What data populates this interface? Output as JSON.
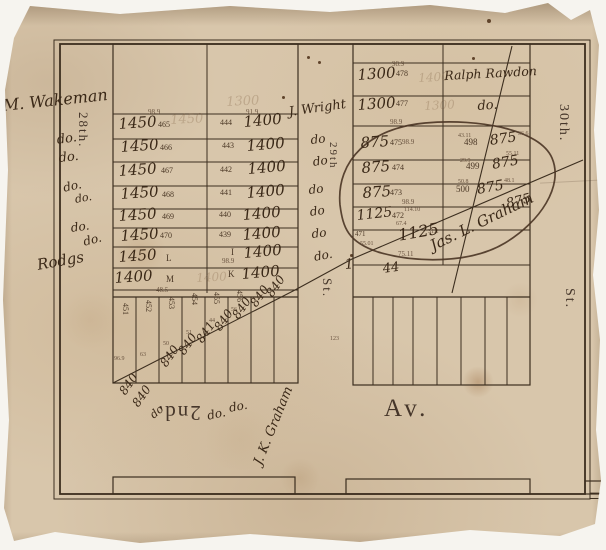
{
  "title": "Antique plat map fragment",
  "streets": {
    "left": "28th.",
    "middle": "29th",
    "middle_st": "St.",
    "right": "30th.",
    "right_st": "St.",
    "avenue_prefix": "2nd.",
    "avenue": "Av."
  },
  "colors": {
    "paper": "#d8c6ab",
    "ink_hand": "#3a2817",
    "ink_print": "#4b3826",
    "line": "#3c2e1f",
    "backdrop": "#f6f4ef"
  },
  "label_groups": {
    "margin_left": [
      {
        "t": "M. Wakeman",
        "x": 2,
        "y": 98,
        "s": 16,
        "r": -6,
        "c": "hand",
        "n": "owner-wakeman"
      },
      {
        "t": "do.",
        "x": 56,
        "y": 134,
        "s": 13,
        "r": -8,
        "c": "hand",
        "n": "ditto-mark"
      },
      {
        "t": "do.",
        "x": 58,
        "y": 152,
        "s": 13,
        "r": -6,
        "c": "hand",
        "n": "ditto-mark"
      },
      {
        "t": "do.",
        "x": 62,
        "y": 182,
        "s": 12,
        "r": -12,
        "c": "hand",
        "n": "ditto-mark"
      },
      {
        "t": "do.",
        "x": 74,
        "y": 194,
        "s": 11,
        "r": -10,
        "c": "hand",
        "n": "ditto-mark"
      },
      {
        "t": "do.",
        "x": 70,
        "y": 222,
        "s": 12,
        "r": -8,
        "c": "hand",
        "n": "ditto-mark"
      },
      {
        "t": "do.",
        "x": 82,
        "y": 236,
        "s": 12,
        "r": -14,
        "c": "hand",
        "n": "ditto-mark"
      },
      {
        "t": "Rodgs",
        "x": 36,
        "y": 258,
        "s": 15,
        "r": -10,
        "c": "hand",
        "n": "owner-rodgers"
      }
    ],
    "block_left": [
      {
        "t": "98.9",
        "x": 148,
        "y": 109,
        "s": 7,
        "c": "tiny",
        "n": "dimension"
      },
      {
        "t": "91.9",
        "x": 246,
        "y": 109,
        "s": 7,
        "c": "tiny",
        "n": "dimension"
      },
      {
        "t": "1450",
        "x": 170,
        "y": 114,
        "s": 13,
        "r": -3,
        "c": "ghost",
        "n": "erased-price"
      },
      {
        "t": "1300",
        "x": 226,
        "y": 96,
        "s": 13,
        "r": -3,
        "c": "ghost",
        "n": "erased-price"
      },
      {
        "t": "1450",
        "x": 118,
        "y": 117,
        "s": 15,
        "r": -4,
        "c": "hand",
        "n": "lot-price"
      },
      {
        "t": "465",
        "x": 158,
        "y": 121,
        "s": 8,
        "c": "print",
        "n": "lot-number"
      },
      {
        "t": "1450",
        "x": 120,
        "y": 140,
        "s": 15,
        "r": -4,
        "c": "hand",
        "n": "lot-price"
      },
      {
        "t": "466",
        "x": 160,
        "y": 144,
        "s": 8,
        "c": "print",
        "n": "lot-number"
      },
      {
        "t": "1450",
        "x": 118,
        "y": 164,
        "s": 15,
        "r": -4,
        "c": "hand",
        "n": "lot-price"
      },
      {
        "t": "467",
        "x": 161,
        "y": 167,
        "s": 8,
        "c": "print",
        "n": "lot-number"
      },
      {
        "t": "1450",
        "x": 120,
        "y": 187,
        "s": 15,
        "r": -4,
        "c": "hand",
        "n": "lot-price"
      },
      {
        "t": "468",
        "x": 162,
        "y": 191,
        "s": 8,
        "c": "print",
        "n": "lot-number"
      },
      {
        "t": "1450",
        "x": 118,
        "y": 209,
        "s": 15,
        "r": -4,
        "c": "hand",
        "n": "lot-price"
      },
      {
        "t": "469",
        "x": 162,
        "y": 213,
        "s": 8,
        "c": "print",
        "n": "lot-number"
      },
      {
        "t": "1450",
        "x": 120,
        "y": 229,
        "s": 15,
        "r": -4,
        "c": "hand",
        "n": "lot-price"
      },
      {
        "t": "470",
        "x": 160,
        "y": 232,
        "s": 8,
        "c": "print",
        "n": "lot-number"
      },
      {
        "t": "1450",
        "x": 118,
        "y": 250,
        "s": 15,
        "r": -4,
        "c": "hand",
        "n": "lot-price"
      },
      {
        "t": "L",
        "x": 166,
        "y": 254,
        "s": 9,
        "c": "print",
        "n": "lot-letter"
      },
      {
        "t": "1400",
        "x": 114,
        "y": 271,
        "s": 15,
        "r": -4,
        "c": "hand",
        "n": "lot-price"
      },
      {
        "t": "M",
        "x": 166,
        "y": 275,
        "s": 9,
        "c": "print",
        "n": "lot-letter"
      },
      {
        "t": "48.5",
        "x": 156,
        "y": 287,
        "s": 7,
        "c": "tiny",
        "n": "dimension"
      },
      {
        "t": "1400",
        "x": 196,
        "y": 272,
        "s": 12,
        "r": -3,
        "c": "ghost",
        "n": "erased-price"
      },
      {
        "t": "444",
        "x": 220,
        "y": 119,
        "s": 8,
        "c": "print",
        "n": "lot-number"
      },
      {
        "t": "1400",
        "x": 243,
        "y": 115,
        "s": 15,
        "r": -5,
        "c": "hand",
        "n": "lot-price"
      },
      {
        "t": "443",
        "x": 222,
        "y": 142,
        "s": 8,
        "c": "print",
        "n": "lot-number"
      },
      {
        "t": "1400",
        "x": 246,
        "y": 139,
        "s": 15,
        "r": -5,
        "c": "hand",
        "n": "lot-price"
      },
      {
        "t": "442",
        "x": 220,
        "y": 166,
        "s": 8,
        "c": "print",
        "n": "lot-number"
      },
      {
        "t": "1400",
        "x": 247,
        "y": 162,
        "s": 15,
        "r": -5,
        "c": "hand",
        "n": "lot-price"
      },
      {
        "t": "441",
        "x": 220,
        "y": 189,
        "s": 8,
        "c": "print",
        "n": "lot-number"
      },
      {
        "t": "1400",
        "x": 246,
        "y": 186,
        "s": 15,
        "r": -5,
        "c": "hand",
        "n": "lot-price"
      },
      {
        "t": "440",
        "x": 219,
        "y": 211,
        "s": 8,
        "c": "print",
        "n": "lot-number"
      },
      {
        "t": "1400",
        "x": 242,
        "y": 208,
        "s": 15,
        "r": -5,
        "c": "hand",
        "n": "lot-price"
      },
      {
        "t": "439",
        "x": 219,
        "y": 231,
        "s": 8,
        "c": "print",
        "n": "lot-number"
      },
      {
        "t": "1400",
        "x": 242,
        "y": 228,
        "s": 15,
        "r": -5,
        "c": "hand",
        "n": "lot-price"
      },
      {
        "t": "I",
        "x": 231,
        "y": 248,
        "s": 9,
        "c": "print",
        "n": "lot-letter"
      },
      {
        "t": "98.9",
        "x": 222,
        "y": 258,
        "s": 7,
        "c": "tiny",
        "n": "dimension"
      },
      {
        "t": "1400",
        "x": 243,
        "y": 246,
        "s": 15,
        "r": -5,
        "c": "hand",
        "n": "lot-price"
      },
      {
        "t": "K",
        "x": 228,
        "y": 270,
        "s": 9,
        "c": "print",
        "n": "lot-letter"
      },
      {
        "t": "1400",
        "x": 241,
        "y": 267,
        "s": 15,
        "r": -5,
        "c": "hand",
        "n": "lot-price"
      }
    ],
    "street_29_column": [
      {
        "t": "J. Wright",
        "x": 288,
        "y": 106,
        "s": 13,
        "r": -8,
        "c": "hand",
        "n": "owner-wright"
      },
      {
        "t": "do",
        "x": 310,
        "y": 134,
        "s": 12,
        "r": -6,
        "c": "hand",
        "n": "ditto-mark"
      },
      {
        "t": "do",
        "x": 312,
        "y": 156,
        "s": 12,
        "r": -8,
        "c": "hand",
        "n": "ditto-mark"
      },
      {
        "t": "do",
        "x": 308,
        "y": 184,
        "s": 12,
        "r": -6,
        "c": "hand",
        "n": "ditto-mark"
      },
      {
        "t": "do",
        "x": 309,
        "y": 206,
        "s": 12,
        "r": -8,
        "c": "hand",
        "n": "ditto-mark"
      },
      {
        "t": "do",
        "x": 311,
        "y": 228,
        "s": 12,
        "r": -6,
        "c": "hand",
        "n": "ditto-mark"
      },
      {
        "t": "do.",
        "x": 313,
        "y": 251,
        "s": 12,
        "r": -10,
        "c": "hand",
        "n": "ditto-mark"
      }
    ],
    "block_right_west": [
      {
        "t": "98.9",
        "x": 392,
        "y": 61,
        "s": 7,
        "c": "tiny",
        "n": "dimension"
      },
      {
        "t": "1300",
        "x": 357,
        "y": 68,
        "s": 15,
        "r": -4,
        "c": "hand",
        "n": "lot-price"
      },
      {
        "t": "478",
        "x": 396,
        "y": 70,
        "s": 8,
        "c": "print",
        "n": "lot-number"
      },
      {
        "t": "1400",
        "x": 418,
        "y": 72,
        "s": 12,
        "r": -3,
        "c": "ghost",
        "n": "erased-price"
      },
      {
        "t": "1300",
        "x": 357,
        "y": 98,
        "s": 15,
        "r": -4,
        "c": "hand",
        "n": "lot-price"
      },
      {
        "t": "477",
        "x": 396,
        "y": 100,
        "s": 8,
        "c": "print",
        "n": "lot-number"
      },
      {
        "t": "1300",
        "x": 424,
        "y": 100,
        "s": 12,
        "r": -3,
        "c": "ghost",
        "n": "erased-price"
      },
      {
        "t": "98.9",
        "x": 390,
        "y": 119,
        "s": 7,
        "c": "tiny",
        "n": "dimension"
      },
      {
        "t": "875",
        "x": 360,
        "y": 136,
        "s": 15,
        "r": -4,
        "c": "hand",
        "n": "lot-price"
      },
      {
        "t": "475",
        "x": 390,
        "y": 139,
        "s": 8,
        "c": "print",
        "n": "lot-number"
      },
      {
        "t": "98.9",
        "x": 402,
        "y": 139,
        "s": 7,
        "c": "tiny",
        "n": "dimension"
      },
      {
        "t": "875",
        "x": 361,
        "y": 161,
        "s": 15,
        "r": -4,
        "c": "hand",
        "n": "lot-price"
      },
      {
        "t": "474",
        "x": 392,
        "y": 164,
        "s": 8,
        "c": "print",
        "n": "lot-number"
      },
      {
        "t": "875",
        "x": 362,
        "y": 186,
        "s": 15,
        "r": -4,
        "c": "hand",
        "n": "lot-price"
      },
      {
        "t": "473",
        "x": 390,
        "y": 189,
        "s": 8,
        "c": "print",
        "n": "lot-number"
      },
      {
        "t": "98.9",
        "x": 402,
        "y": 199,
        "s": 7,
        "c": "tiny",
        "n": "dimension"
      },
      {
        "t": "1125",
        "x": 356,
        "y": 209,
        "s": 14,
        "r": -6,
        "c": "hand",
        "n": "lot-price"
      },
      {
        "t": "472",
        "x": 392,
        "y": 212,
        "s": 8,
        "c": "print",
        "n": "lot-number"
      },
      {
        "t": "114.10",
        "x": 404,
        "y": 207,
        "s": 6,
        "c": "tiny",
        "n": "dimension"
      },
      {
        "t": "67.4",
        "x": 396,
        "y": 221,
        "s": 6,
        "c": "tiny",
        "n": "dimension"
      },
      {
        "t": "471",
        "x": 355,
        "y": 231,
        "s": 7,
        "c": "print",
        "n": "lot-number"
      },
      {
        "t": "55.01",
        "x": 360,
        "y": 241,
        "s": 6,
        "c": "tiny",
        "n": "dimension"
      },
      {
        "t": "31.2",
        "x": 428,
        "y": 229,
        "s": 6,
        "c": "tiny",
        "n": "dimension"
      },
      {
        "t": "1125",
        "x": 397,
        "y": 228,
        "s": 16,
        "r": -10,
        "c": "hand",
        "n": "lot-price"
      },
      {
        "t": "75.11",
        "x": 398,
        "y": 251,
        "s": 7,
        "c": "tiny",
        "n": "dimension"
      },
      {
        "t": "1",
        "x": 344,
        "y": 258,
        "s": 14,
        "r": -5,
        "c": "hand",
        "n": "hand-mark"
      },
      {
        "t": "44",
        "x": 382,
        "y": 263,
        "s": 13,
        "r": -8,
        "c": "hand",
        "n": "hand-mark"
      }
    ],
    "block_right_east": [
      {
        "t": "Ralph Rawdon",
        "x": 444,
        "y": 70,
        "s": 12.5,
        "r": -3,
        "c": "hand",
        "n": "owner-rawdon"
      },
      {
        "t": "do.",
        "x": 477,
        "y": 100,
        "s": 13,
        "r": -4,
        "c": "hand",
        "n": "ditto-mark"
      },
      {
        "t": "43.11",
        "x": 458,
        "y": 133,
        "s": 6,
        "c": "tiny",
        "n": "dimension"
      },
      {
        "t": "36.6",
        "x": 518,
        "y": 131,
        "s": 6,
        "c": "tiny",
        "n": "dimension"
      },
      {
        "t": "498",
        "x": 464,
        "y": 138,
        "s": 9,
        "c": "print",
        "n": "lot-number"
      },
      {
        "t": "875",
        "x": 489,
        "y": 134,
        "s": 14,
        "r": -8,
        "c": "hand",
        "n": "lot-price"
      },
      {
        "t": "55.11",
        "x": 506,
        "y": 151,
        "s": 6,
        "c": "tiny",
        "n": "dimension"
      },
      {
        "t": "29.9",
        "x": 460,
        "y": 158,
        "s": 6,
        "c": "tiny",
        "n": "dimension"
      },
      {
        "t": "499",
        "x": 466,
        "y": 162,
        "s": 9,
        "c": "print",
        "n": "lot-number"
      },
      {
        "t": "875",
        "x": 491,
        "y": 158,
        "s": 14,
        "r": -10,
        "c": "hand",
        "n": "lot-price"
      },
      {
        "t": "50.8",
        "x": 458,
        "y": 179,
        "s": 6,
        "c": "tiny",
        "n": "dimension"
      },
      {
        "t": "48.1",
        "x": 504,
        "y": 178,
        "s": 6,
        "c": "tiny",
        "n": "dimension"
      },
      {
        "t": "500",
        "x": 456,
        "y": 185,
        "s": 9,
        "c": "print",
        "n": "lot-number"
      },
      {
        "t": "875",
        "x": 476,
        "y": 183,
        "s": 14,
        "r": -10,
        "c": "hand",
        "n": "lot-price"
      },
      {
        "t": "875",
        "x": 505,
        "y": 198,
        "s": 13,
        "r": -14,
        "c": "hand",
        "n": "lot-price"
      },
      {
        "t": "Jas. L. Graham",
        "x": 428,
        "y": 240,
        "s": 15,
        "r": -26,
        "c": "hand",
        "n": "owner-graham-signature"
      }
    ],
    "strips_south": [
      {
        "t": "451",
        "x": 129,
        "y": 303,
        "s": 8,
        "r": 90,
        "c": "print",
        "n": "lot-number"
      },
      {
        "t": "452",
        "x": 152,
        "y": 300,
        "s": 8,
        "r": 90,
        "c": "print",
        "n": "lot-number"
      },
      {
        "t": "453",
        "x": 175,
        "y": 297,
        "s": 8,
        "r": 90,
        "c": "print",
        "n": "lot-number"
      },
      {
        "t": "454",
        "x": 198,
        "y": 293,
        "s": 8,
        "r": 90,
        "c": "print",
        "n": "lot-number"
      },
      {
        "t": "455",
        "x": 220,
        "y": 292,
        "s": 8,
        "r": 90,
        "c": "print",
        "n": "lot-number"
      },
      {
        "t": "456",
        "x": 243,
        "y": 290,
        "s": 8,
        "r": 90,
        "c": "print",
        "n": "lot-number"
      },
      {
        "t": "96.9",
        "x": 114,
        "y": 356,
        "s": 6,
        "c": "tiny",
        "n": "dimension"
      },
      {
        "t": "63",
        "x": 140,
        "y": 352,
        "s": 6,
        "c": "tiny",
        "n": "dimension"
      },
      {
        "t": "50",
        "x": 163,
        "y": 341,
        "s": 6,
        "c": "tiny",
        "n": "dimension"
      },
      {
        "t": "51",
        "x": 186,
        "y": 330,
        "s": 6,
        "c": "tiny",
        "n": "dimension"
      },
      {
        "t": "44",
        "x": 209,
        "y": 318,
        "s": 6,
        "c": "tiny",
        "n": "dimension"
      },
      {
        "t": "56",
        "x": 231,
        "y": 307,
        "s": 6,
        "c": "tiny",
        "n": "dimension"
      },
      {
        "t": "123",
        "x": 330,
        "y": 336,
        "s": 6,
        "c": "tiny",
        "n": "dimension"
      },
      {
        "t": "840",
        "x": 158,
        "y": 362,
        "s": 12,
        "r": -55,
        "c": "hand",
        "n": "lot-price"
      },
      {
        "t": "840",
        "x": 176,
        "y": 350,
        "s": 12,
        "r": -55,
        "c": "hand",
        "n": "lot-price"
      },
      {
        "t": "841",
        "x": 194,
        "y": 338,
        "s": 12,
        "r": -55,
        "c": "hand",
        "n": "lot-price"
      },
      {
        "t": "840",
        "x": 212,
        "y": 326,
        "s": 12,
        "r": -55,
        "c": "hand",
        "n": "lot-price"
      },
      {
        "t": "840",
        "x": 230,
        "y": 314,
        "s": 12,
        "r": -55,
        "c": "hand",
        "n": "lot-price"
      },
      {
        "t": "840",
        "x": 248,
        "y": 302,
        "s": 12,
        "r": -55,
        "c": "hand",
        "n": "lot-price"
      },
      {
        "t": "840",
        "x": 264,
        "y": 292,
        "s": 12,
        "r": -55,
        "c": "hand",
        "n": "lot-price"
      },
      {
        "t": "840",
        "x": 117,
        "y": 390,
        "s": 12,
        "r": -55,
        "c": "hand",
        "n": "lot-price"
      },
      {
        "t": "840",
        "x": 130,
        "y": 402,
        "s": 12,
        "r": -55,
        "c": "hand",
        "n": "lot-price"
      },
      {
        "t": "do",
        "x": 148,
        "y": 412,
        "s": 11,
        "r": -40,
        "c": "hand",
        "n": "ditto-mark"
      }
    ],
    "bottom_area": [
      {
        "t": "do.",
        "x": 206,
        "y": 410,
        "s": 12,
        "r": -12,
        "c": "hand",
        "n": "ditto-mark"
      },
      {
        "t": "do.",
        "x": 228,
        "y": 402,
        "s": 12,
        "r": -10,
        "c": "hand",
        "n": "ditto-mark"
      },
      {
        "t": "J. K. Graham",
        "x": 252,
        "y": 462,
        "s": 13,
        "r": -68,
        "c": "hand",
        "n": "owner-jk-graham"
      }
    ]
  }
}
